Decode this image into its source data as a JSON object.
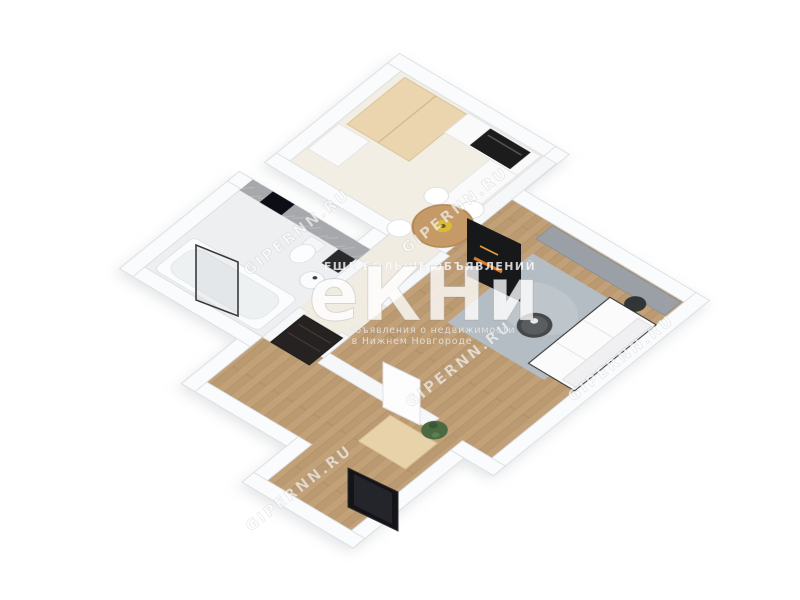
{
  "scene": {
    "description": "3D isometric floor plan render of a one-room apartment",
    "background": "#ffffff"
  },
  "watermarks": {
    "diagonal": {
      "text": "GIPERNN.RU"
    },
    "logo": {
      "main": "еКНи",
      "top_line": "ЕЩЕ БОЛЬШЕ ОБЪЯВЛЕНИЙ",
      "sub_line1": "объявления о недвижимости",
      "sub_line2": "в Нижнем Новгороде"
    }
  },
  "palette": {
    "wall": "#f6f7f9",
    "wood_floor": "#c2a178",
    "kitchen_floor": "#f2eee4",
    "bathroom_floor": "#edeff0",
    "tile_wall": "#a6a8ab",
    "cabinet_beige": "#ead5ae",
    "rug": "#b5bdc4",
    "appliance_black": "#1c1c1e",
    "table_wood": "#c59a66",
    "plate_yellow": "#ddbb39",
    "plant_green": "#4b6a43",
    "fire_orange": "#d97a28"
  },
  "rooms": {
    "kitchen": {
      "furniture": [
        "tall wardrobe",
        "kitchen counter",
        "oven",
        "dining table",
        "chairs",
        "media panel"
      ]
    },
    "living_room": {
      "furniture": [
        "sideboard",
        "rug",
        "coffee table",
        "sofa",
        "side table"
      ]
    },
    "bathroom": {
      "furniture": [
        "bathtub",
        "glass screen",
        "toilet",
        "washbasin",
        "mirror",
        "wall niche"
      ]
    },
    "hallway": {
      "furniture": [
        "dark chest",
        "shoe cabinet",
        "plant",
        "white door",
        "black floor mirror"
      ]
    }
  }
}
